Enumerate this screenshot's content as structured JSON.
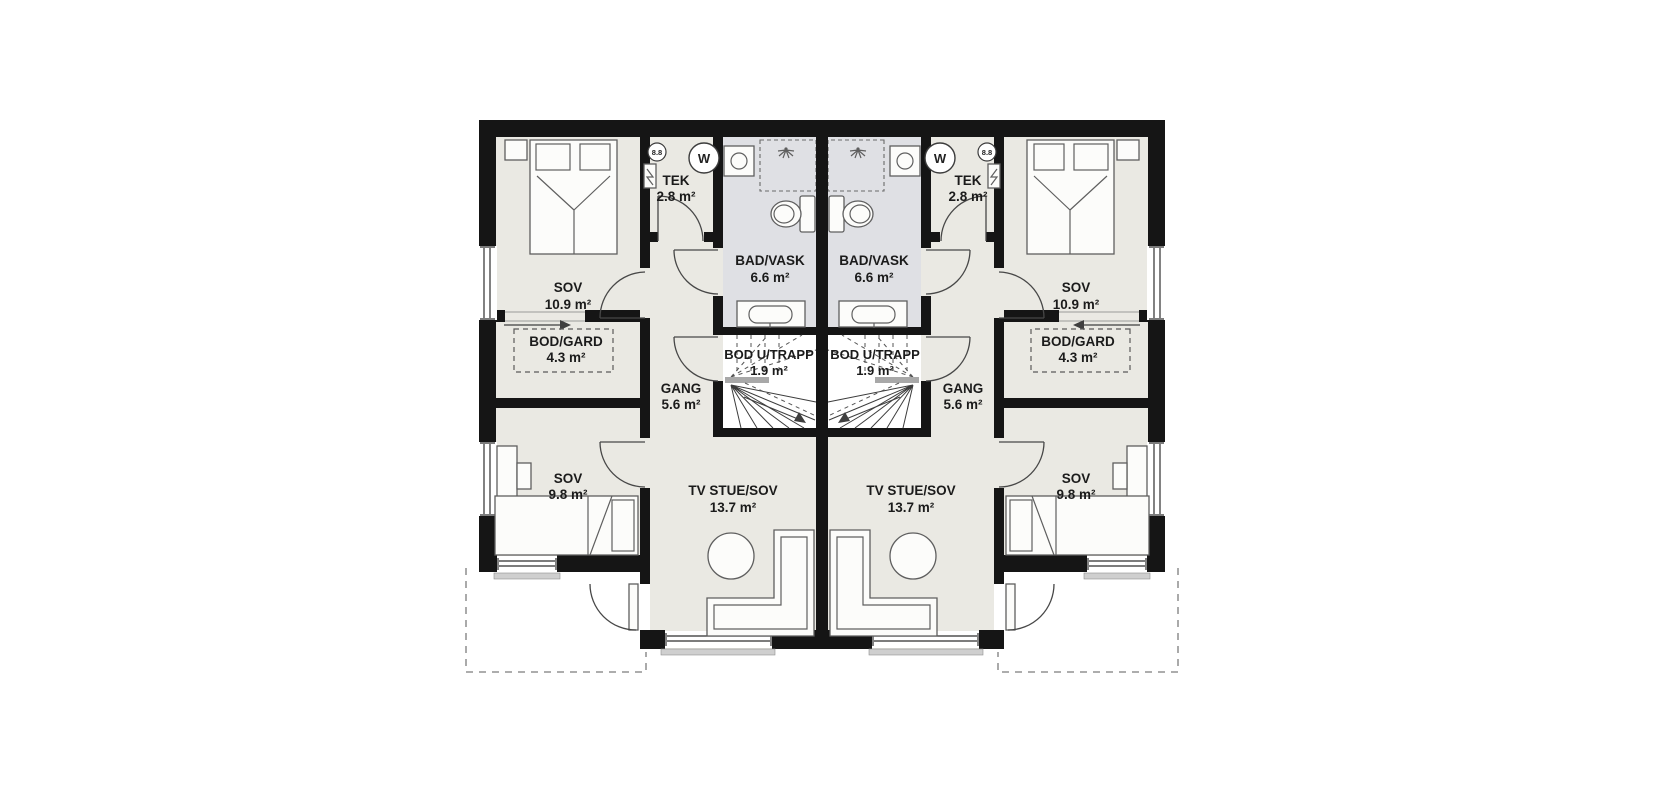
{
  "plan": {
    "type": "residential-floor-plan",
    "colors": {
      "wall": "#151515",
      "room_fill": "#eae9e3",
      "bath_fill": "#dfe0e4",
      "stair_fill": "#ffffff",
      "background": "#ffffff"
    },
    "units": [
      {
        "side": "left",
        "rooms": [
          {
            "name": "SOV",
            "area": "10.9 m²"
          },
          {
            "name": "TEK",
            "area": "2.8 m²"
          },
          {
            "name": "BAD/VASK",
            "area": "6.6 m²"
          },
          {
            "name": "BOD/GARD",
            "area": "4.3 m²"
          },
          {
            "name": "GANG",
            "area": "5.6 m²"
          },
          {
            "name": "BOD U/TRAPP",
            "area": "1.9 m²"
          },
          {
            "name": "SOV",
            "area": "9.8 m²"
          },
          {
            "name": "TV STUE/SOV",
            "area": "13.7 m²"
          }
        ],
        "markers": {
          "detector": "8.8",
          "water_heater": "W"
        }
      },
      {
        "side": "right",
        "rooms": [
          {
            "name": "SOV",
            "area": "10.9 m²"
          },
          {
            "name": "TEK",
            "area": "2.8 m²"
          },
          {
            "name": "BAD/VASK",
            "area": "6.6 m²"
          },
          {
            "name": "BOD/GARD",
            "area": "4.3 m²"
          },
          {
            "name": "GANG",
            "area": "5.6 m²"
          },
          {
            "name": "BOD U/TRAPP",
            "area": "1.9 m²"
          },
          {
            "name": "SOV",
            "area": "9.8 m²"
          },
          {
            "name": "TV STUE/SOV",
            "area": "13.7 m²"
          }
        ],
        "markers": {
          "detector": "8.8",
          "water_heater": "W"
        }
      }
    ]
  }
}
